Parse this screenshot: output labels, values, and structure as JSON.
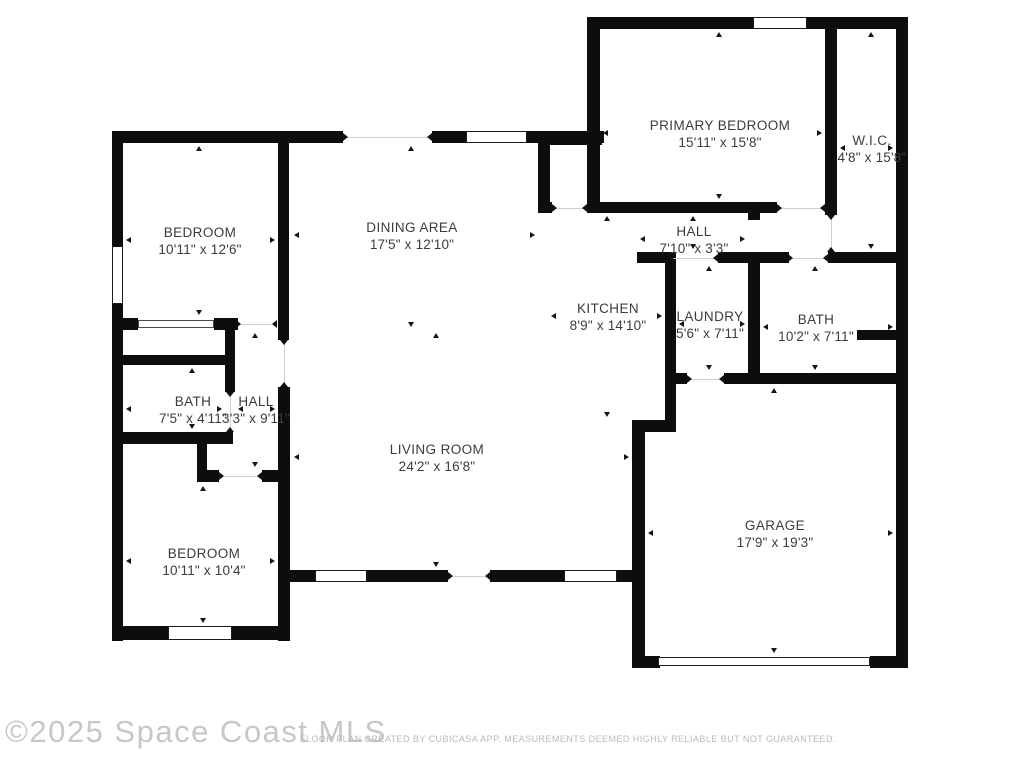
{
  "watermark": "©2025 Space Coast MLS",
  "caption": "FLOOR PLAN CREATED BY CUBICASA APP. MEASUREMENTS DEEMED HIGHLY RELIABLE BUT NOT GUARANTEED.",
  "colors": {
    "wall": "#0d0d0d",
    "label": "#3c3c3c",
    "watermark": "#c7c7c7",
    "caption": "#b4bbc1"
  },
  "rooms": [
    {
      "name": "BEDROOM",
      "dims": "10'11\" x 12'6\"",
      "cx": 200,
      "cy": 241,
      "x1": 126,
      "y1": 146,
      "x2": 275,
      "y2": 315
    },
    {
      "name": "DINING AREA",
      "dims": "17'5\" x 12'10\"",
      "cx": 412,
      "cy": 236,
      "x1": 294,
      "y1": 146,
      "x2": 535,
      "y2": 327
    },
    {
      "name": "PRIMARY BEDROOM",
      "dims": "15'11\" x 15'8\"",
      "cx": 720,
      "cy": 134,
      "x1": 603,
      "y1": 32,
      "x2": 822,
      "y2": 199
    },
    {
      "name": "W.I.C.",
      "dims": "4'8\" x 15'8\"",
      "cx": 872,
      "cy": 149,
      "x1": 840,
      "y1": 32,
      "x2": 893,
      "y2": 249
    },
    {
      "name": "HALL",
      "dims": "7'10\" x 3'3\"",
      "cx": 694,
      "cy": 240,
      "x1": 640,
      "y1": 216,
      "x2": 745,
      "y2": 249
    },
    {
      "name": "KITCHEN",
      "dims": "8'9\" x 14'10\"",
      "cx": 608,
      "cy": 317,
      "x1": 551,
      "y1": 216,
      "x2": 662,
      "y2": 417
    },
    {
      "name": "LAUNDRY",
      "dims": "5'6\" x 7'11\"",
      "cx": 710,
      "cy": 325,
      "x1": 679,
      "y1": 266,
      "x2": 745,
      "y2": 370
    },
    {
      "name": "BATH",
      "dims": "10'2\" x 7'11\"",
      "cx": 816,
      "cy": 328,
      "x1": 763,
      "y1": 266,
      "x2": 893,
      "y2": 370
    },
    {
      "name": "BATH",
      "dims": "7'5\" x 4'11\"",
      "cx": 193,
      "cy": 410,
      "x1": 126,
      "y1": 368,
      "x2": 222,
      "y2": 429
    },
    {
      "name": "HALL",
      "dims": "3'3\" x 9'11\"",
      "cx": 256,
      "cy": 410,
      "x1": 238,
      "y1": 333,
      "x2": 275,
      "y2": 467
    },
    {
      "name": "LIVING ROOM",
      "dims": "24'2\" x 16'8\"",
      "cx": 437,
      "cy": 458,
      "x1": 294,
      "y1": 333,
      "x2": 629,
      "y2": 567
    },
    {
      "name": "BEDROOM",
      "dims": "10'11\" x 10'4\"",
      "cx": 204,
      "cy": 562,
      "x1": 126,
      "y1": 486,
      "x2": 275,
      "y2": 623
    },
    {
      "name": "GARAGE",
      "dims": "17'9\" x 19'3\"",
      "cx": 775,
      "cy": 534,
      "x1": 648,
      "y1": 388,
      "x2": 893,
      "y2": 653
    }
  ],
  "walls": [
    [
      112,
      131,
      231,
      12
    ],
    [
      432,
      131,
      36,
      12
    ],
    [
      527,
      131,
      77,
      12
    ],
    [
      538,
      135,
      64,
      10
    ],
    [
      590,
      17,
      163,
      12
    ],
    [
      807,
      17,
      101,
      12
    ],
    [
      112,
      131,
      11,
      510
    ],
    [
      278,
      131,
      11,
      209
    ],
    [
      278,
      387,
      12,
      254
    ],
    [
      538,
      143,
      12,
      69
    ],
    [
      587,
      17,
      13,
      196
    ],
    [
      825,
      27,
      12,
      188
    ],
    [
      896,
      17,
      12,
      651
    ],
    [
      665,
      252,
      11,
      180
    ],
    [
      748,
      202,
      12,
      18
    ],
    [
      748,
      263,
      12,
      114
    ],
    [
      632,
      420,
      13,
      248
    ],
    [
      225,
      330,
      10,
      62
    ],
    [
      197,
      444,
      10,
      32
    ],
    [
      587,
      202,
      190,
      11
    ],
    [
      538,
      202,
      14,
      11
    ],
    [
      637,
      252,
      32,
      11
    ],
    [
      718,
      252,
      71,
      11
    ],
    [
      828,
      252,
      80,
      11
    ],
    [
      665,
      373,
      22,
      11
    ],
    [
      724,
      373,
      184,
      11
    ],
    [
      857,
      330,
      51,
      10
    ],
    [
      632,
      420,
      44,
      12
    ],
    [
      632,
      656,
      28,
      12
    ],
    [
      870,
      656,
      38,
      12
    ],
    [
      112,
      318,
      26,
      12
    ],
    [
      214,
      318,
      24,
      12
    ],
    [
      123,
      355,
      104,
      10
    ],
    [
      112,
      432,
      121,
      12
    ],
    [
      197,
      470,
      22,
      12
    ],
    [
      262,
      470,
      28,
      12
    ],
    [
      290,
      570,
      25,
      12
    ],
    [
      367,
      570,
      81,
      12
    ],
    [
      490,
      570,
      74,
      12
    ],
    [
      617,
      570,
      21,
      12
    ],
    [
      112,
      626,
      56,
      14
    ],
    [
      232,
      626,
      58,
      14
    ]
  ],
  "windows": [
    {
      "x": 466,
      "y": 131,
      "w": 61,
      "h": 12,
      "t": "window"
    },
    {
      "x": 753,
      "y": 17,
      "w": 54,
      "h": 12,
      "t": "window"
    },
    {
      "x": 112,
      "y": 246,
      "w": 11,
      "h": 58,
      "t": "window"
    },
    {
      "x": 315,
      "y": 570,
      "w": 52,
      "h": 12,
      "t": "window"
    },
    {
      "x": 564,
      "y": 570,
      "w": 53,
      "h": 12,
      "t": "window"
    },
    {
      "x": 168,
      "y": 626,
      "w": 64,
      "h": 14,
      "t": "window"
    },
    {
      "x": 138,
      "y": 320,
      "w": 76,
      "h": 8,
      "t": "closet"
    },
    {
      "x": 658,
      "y": 657,
      "w": 212,
      "h": 9,
      "t": "garage"
    }
  ],
  "doors": [
    {
      "x": 236,
      "y": 318,
      "w": 41,
      "h": 12,
      "dir": "h"
    },
    {
      "x": 225,
      "y": 392,
      "w": 10,
      "h": 40,
      "dir": "v"
    },
    {
      "x": 219,
      "y": 470,
      "w": 43,
      "h": 12,
      "dir": "h"
    },
    {
      "x": 552,
      "y": 202,
      "w": 35,
      "h": 11,
      "dir": "h"
    },
    {
      "x": 669,
      "y": 252,
      "w": 49,
      "h": 11,
      "dir": "h"
    },
    {
      "x": 788,
      "y": 252,
      "w": 40,
      "h": 11,
      "dir": "h"
    },
    {
      "x": 777,
      "y": 202,
      "w": 48,
      "h": 11,
      "dir": "h"
    },
    {
      "x": 825,
      "y": 215,
      "w": 12,
      "h": 37,
      "dir": "v"
    },
    {
      "x": 687,
      "y": 373,
      "w": 37,
      "h": 11,
      "dir": "h"
    },
    {
      "x": 278,
      "y": 340,
      "w": 11,
      "h": 47,
      "dir": "v"
    },
    {
      "x": 343,
      "y": 131,
      "w": 89,
      "h": 12,
      "dir": "h"
    },
    {
      "x": 448,
      "y": 570,
      "w": 42,
      "h": 12,
      "dir": "h"
    }
  ]
}
